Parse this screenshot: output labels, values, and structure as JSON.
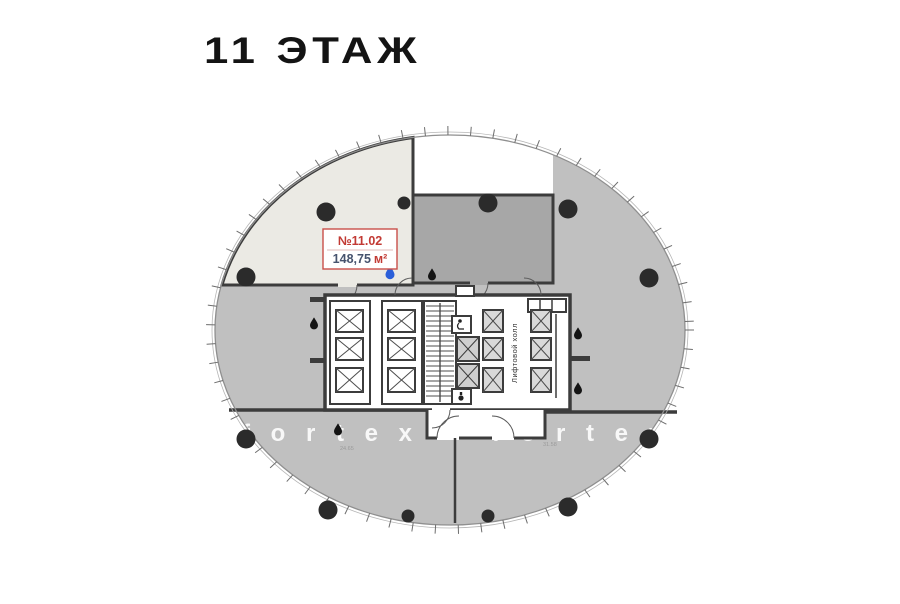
{
  "page": {
    "title": "11 ЭТАЖ"
  },
  "plan": {
    "highlighted_unit": {
      "number": "№11.02",
      "area": "148,75",
      "area_unit": "м²",
      "number_color": "#c23a34",
      "area_color": "#46536e",
      "box_border_color": "#c94f49",
      "fill_color": "#ebeae4"
    },
    "core": {
      "elevator_hall_label": "Лифтовой холл"
    },
    "watermark": {
      "text": "f o r t e x",
      "color": "#ffffff"
    },
    "dimensions": {
      "left": "24.65",
      "right": "31.58"
    },
    "colors": {
      "floor": "#c0c0c0",
      "dark_unit": "#a7a7a7",
      "wall": "#3c3c3c",
      "outline": "#8f8f8f",
      "column": "#2b2b2b",
      "drop_black": "#141414",
      "drop_blue": "#2b5fd9"
    },
    "features": {
      "columns_large": [
        {
          "x": 326,
          "y": 212
        },
        {
          "x": 488,
          "y": 203
        },
        {
          "x": 568,
          "y": 209
        },
        {
          "x": 649,
          "y": 278
        },
        {
          "x": 246,
          "y": 277
        },
        {
          "x": 246,
          "y": 439
        },
        {
          "x": 328,
          "y": 510
        },
        {
          "x": 568,
          "y": 507
        },
        {
          "x": 649,
          "y": 439
        }
      ],
      "columns_small": [
        {
          "x": 404,
          "y": 203
        },
        {
          "x": 408,
          "y": 516
        },
        {
          "x": 488,
          "y": 516
        }
      ],
      "drops_black": [
        {
          "x": 432,
          "y": 274
        },
        {
          "x": 314,
          "y": 323
        },
        {
          "x": 338,
          "y": 429
        },
        {
          "x": 578,
          "y": 333
        },
        {
          "x": 578,
          "y": 388
        }
      ],
      "drop_blue": {
        "x": 390,
        "y": 272
      }
    }
  }
}
